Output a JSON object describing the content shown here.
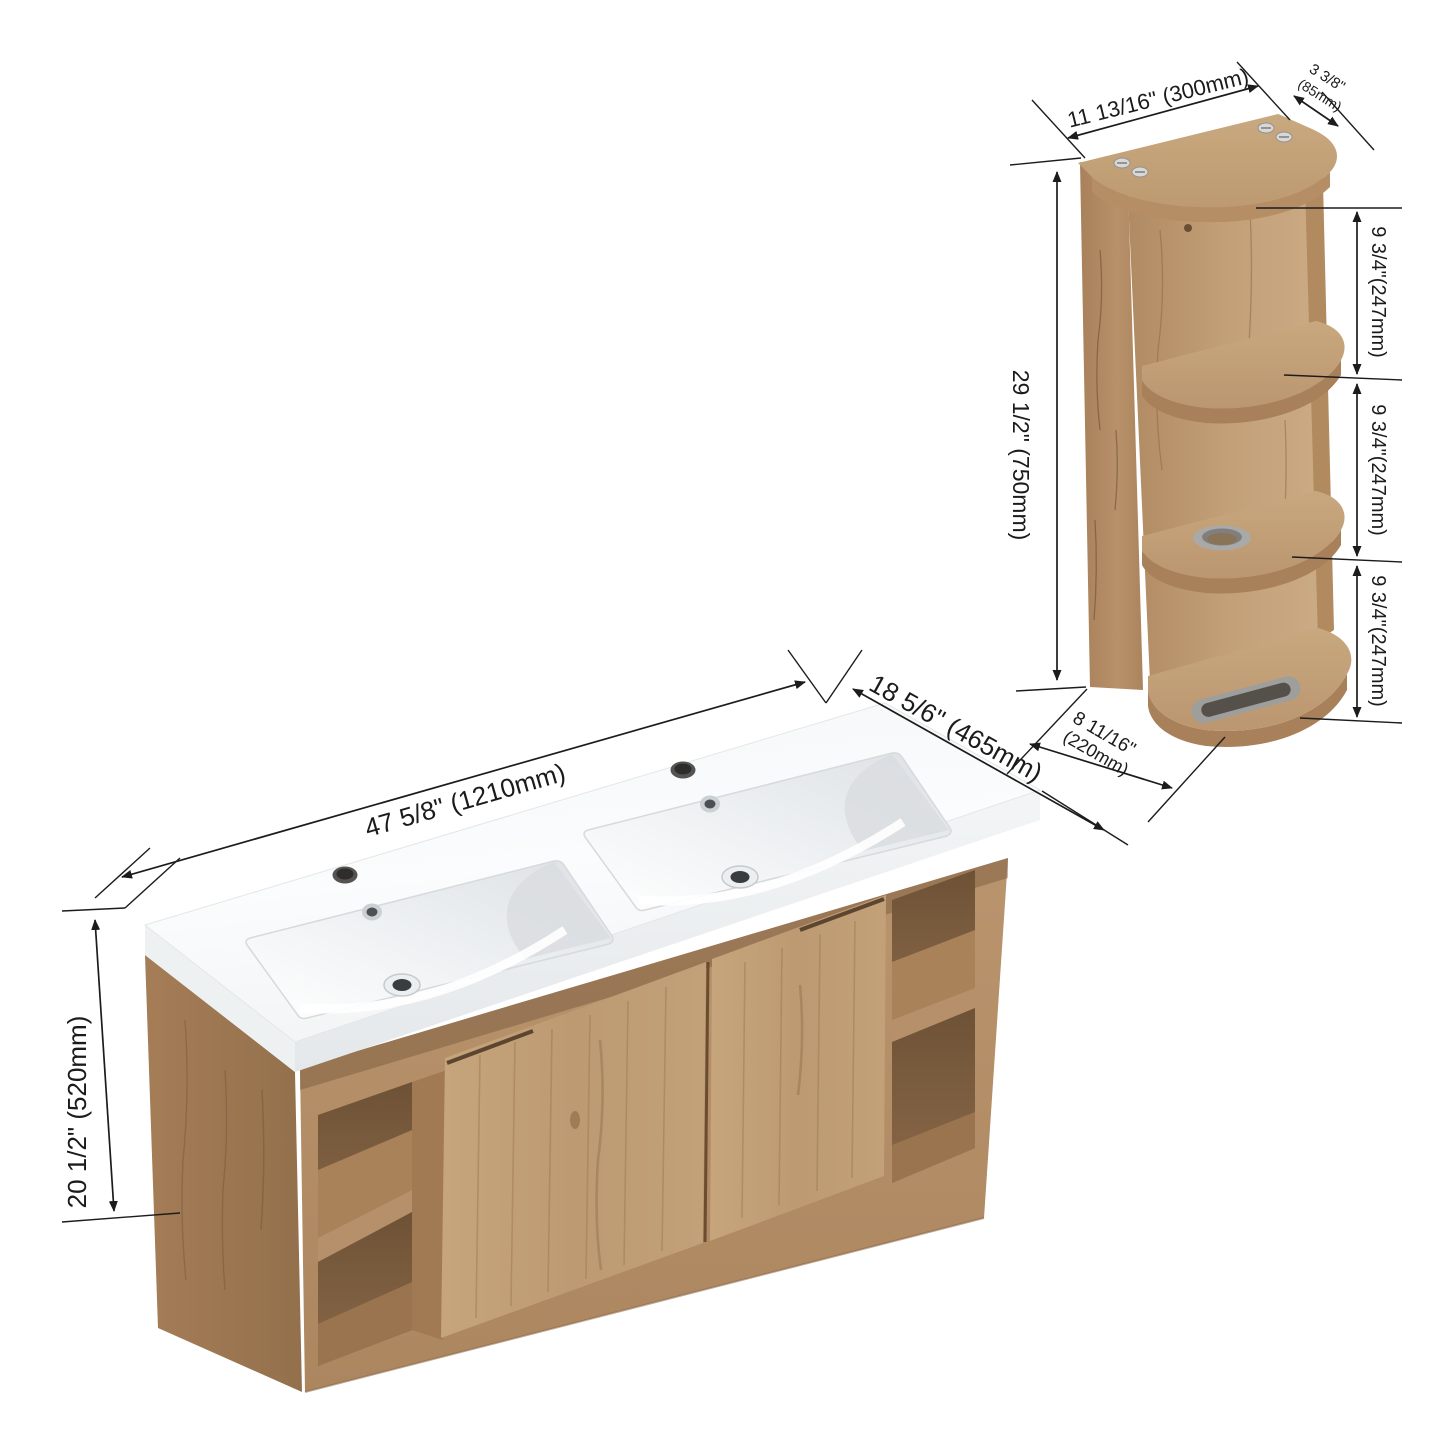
{
  "diagram_type": "product-dimension-drawing",
  "units": {
    "primary": "inches",
    "secondary": "mm"
  },
  "vanity": {
    "name": "wall-hung double-sink bathroom vanity",
    "width_label": "47 5/8\"  (1210mm)",
    "depth_label": "18 5/6\" (465mm)",
    "height_label": "20 1/2\"  (520mm)"
  },
  "side_cabinet": {
    "name": "wall-mounted corner shelf cabinet",
    "width_label": "11 13/16\"  (300mm)",
    "top_depth_line1": "3 3/8\"",
    "top_depth_line2": "(85mm)",
    "height_label": "29 1/2\" (750mm)",
    "shelf_gap_labels": [
      "9 3/4\"(247mm)",
      "9 3/4\"(247mm)",
      "9 3/4\"(247mm)"
    ],
    "bottom_depth_line1": "8 11/16\"",
    "bottom_depth_line2": "(220mm)"
  },
  "colors": {
    "background": "#ffffff",
    "dimension_line": "#1c1c1c",
    "wood_light": "#c2a078",
    "wood_mid": "#b5906a",
    "wood_dark": "#9c7854",
    "wood_interior": "#7c5c3e",
    "counter_white": "#fafbfc",
    "basin_shade": "#dcdfe2",
    "metal": "#a6a6a4"
  }
}
